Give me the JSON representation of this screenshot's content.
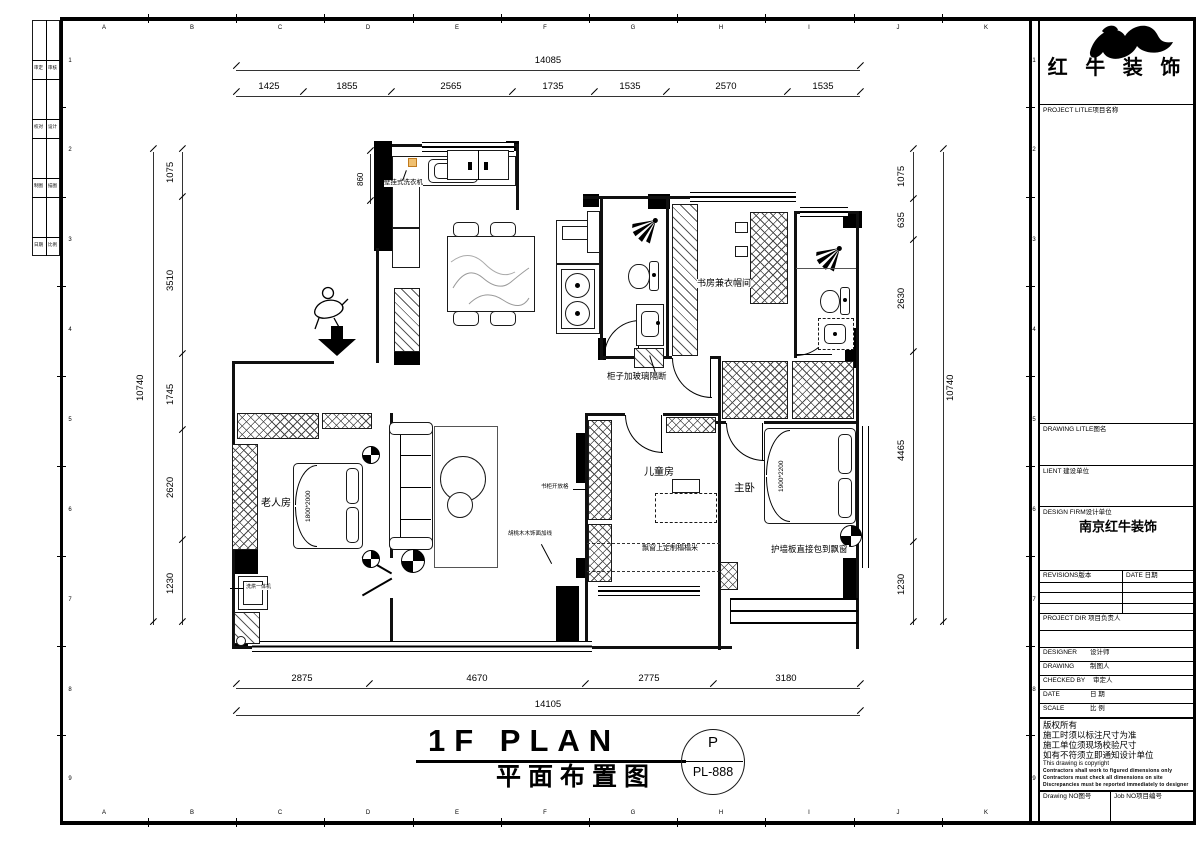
{
  "grid": {
    "letters": [
      "A",
      "B",
      "C",
      "D",
      "E",
      "F",
      "G",
      "H",
      "I",
      "J",
      "K"
    ],
    "numbers": [
      "1",
      "2",
      "3",
      "4",
      "5",
      "6",
      "7",
      "8",
      "9"
    ]
  },
  "dims": {
    "top_total": "14085",
    "top_segments": [
      "1425",
      "1855",
      "2565",
      "1735",
      "1535",
      "2570",
      "1535"
    ],
    "bottom_segments": [
      "2875",
      "4670",
      "2775",
      "3180"
    ],
    "bottom_total": "14105",
    "left_total": "10740",
    "left_segments": [
      "1075",
      "3510",
      "1745",
      "2620",
      "1230"
    ],
    "right_total": "10740",
    "right_segments": [
      "1075",
      "635",
      "2630",
      "4465",
      "1230"
    ],
    "washer_width": "860"
  },
  "rooms": {
    "elder": "老人房",
    "child": "儿童房",
    "master": "主卧",
    "study": "书房兼衣帽间"
  },
  "beds": {
    "elder": "1800*2000",
    "master": "1900*2200"
  },
  "notes": {
    "wall_washer": "壁挂式洗衣机",
    "glass_cabinet": "柜子加玻璃隔断",
    "tatami": "飘窗上定制榻榻米",
    "wall_panel": "护墙板直接包到飘窗",
    "bookshelf": "书柜开放格",
    "walnut": "胡桃木木饰面加线",
    "washer_dryer": "洗烘一体机"
  },
  "titlebar": {
    "en": "1F PLAN",
    "zh": "平面布置图",
    "stamp_letter": "P",
    "stamp_no": "PL-888"
  },
  "logo": {
    "name": "红 牛 装 饰"
  },
  "titleblock": {
    "project_title_label": "PROJECT LITLE项目名称",
    "drawing_title_label": "DRAWING LITLE图名",
    "client_label": "LIENT 建设单位",
    "design_firm_label": "DESIGN FIRM设计单位",
    "design_firm_value": "南京红牛装饰",
    "revisions_label": "REVISIONS版本",
    "revision_date_label": "DATE 日期",
    "project_dir_label": "PROJECT DIR 项目负责人",
    "rows": [
      {
        "en": "DESIGNER",
        "zh": "设计师"
      },
      {
        "en": "DRAWING",
        "zh": "制图人"
      },
      {
        "en": "CHECKED BY",
        "zh": "审定人"
      },
      {
        "en": "DATE",
        "zh": "日 期"
      },
      {
        "en": "SCALE",
        "zh": "比 例"
      }
    ],
    "copyright_zh": [
      "版权所有",
      "施工时须以标注尺寸为准",
      "施工单位须现场校验尺寸",
      "如有不符须立即通知设计单位"
    ],
    "copyright_en": "This drawing is copyright",
    "copyright_small": [
      "Contractors shall work to figured dimensions only",
      "Contractors must check all dimensions on site",
      "Discrepancies must be reported immediately to designer"
    ],
    "drawing_no_label": "Drawing NO图号",
    "job_no_label": "Job NO项目编号"
  },
  "strip": {
    "r1a": "审定",
    "r1b": "审核",
    "r2a": "校对",
    "r2b": "设计",
    "r3a": "制图",
    "r3b": "描图",
    "r4a": "日期",
    "r4b": "比例"
  }
}
